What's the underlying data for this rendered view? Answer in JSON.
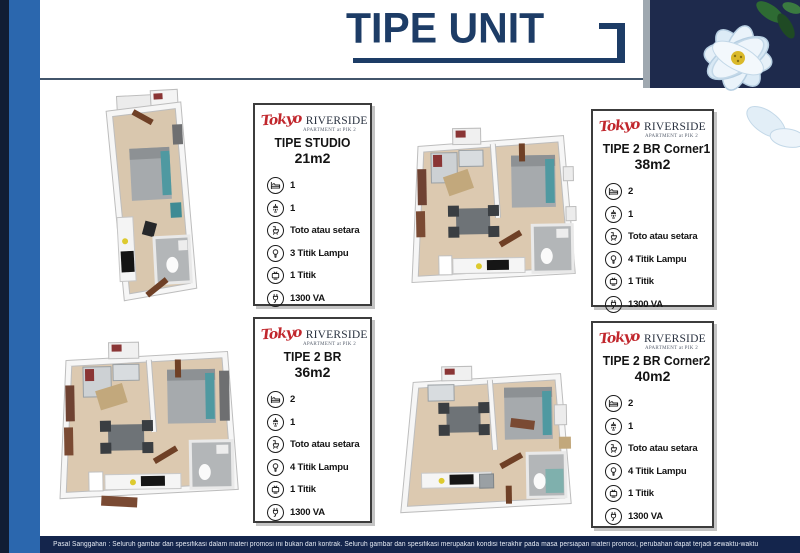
{
  "header": {
    "title": "TIPE UNIT"
  },
  "brand": {
    "script": "Tokyo",
    "serif": "RIVERSIDE",
    "sub": "APARTMENT at PIK 2"
  },
  "colors": {
    "title_navy": "#1d3c66",
    "panel_navy": "#1e2a4c",
    "side_blue": "#2b67ae",
    "footer_navy": "#14254c",
    "logo_red": "#c1272d"
  },
  "units": [
    {
      "name": "TIPE STUDIO",
      "size": "21m2",
      "specs": [
        {
          "icon": "bed-icon",
          "label": "1"
        },
        {
          "icon": "shower-icon",
          "label": "1"
        },
        {
          "icon": "toilet-icon",
          "label": "Toto atau setara"
        },
        {
          "icon": "lamp-icon",
          "label": "3 Titik Lampu"
        },
        {
          "icon": "tv-icon",
          "label": "1 Titik"
        },
        {
          "icon": "power-icon",
          "label": "1300 VA"
        }
      ]
    },
    {
      "name": "TIPE 2 BR Corner1",
      "size": "38m2",
      "specs": [
        {
          "icon": "bed-icon",
          "label": "2"
        },
        {
          "icon": "shower-icon",
          "label": "1"
        },
        {
          "icon": "toilet-icon",
          "label": "Toto atau setara"
        },
        {
          "icon": "lamp-icon",
          "label": "4 Titik Lampu"
        },
        {
          "icon": "tv-icon",
          "label": "1 Titik"
        },
        {
          "icon": "power-icon",
          "label": "1300 VA"
        }
      ]
    },
    {
      "name": "TIPE 2 BR",
      "size": "36m2",
      "specs": [
        {
          "icon": "bed-icon",
          "label": "2"
        },
        {
          "icon": "shower-icon",
          "label": "1"
        },
        {
          "icon": "toilet-icon",
          "label": "Toto atau setara"
        },
        {
          "icon": "lamp-icon",
          "label": "4 Titik Lampu"
        },
        {
          "icon": "tv-icon",
          "label": "1 Titik"
        },
        {
          "icon": "power-icon",
          "label": "1300 VA"
        }
      ]
    },
    {
      "name": "TIPE 2 BR Corner2",
      "size": "40m2",
      "specs": [
        {
          "icon": "bed-icon",
          "label": "2"
        },
        {
          "icon": "shower-icon",
          "label": "1"
        },
        {
          "icon": "toilet-icon",
          "label": "Toto atau setara"
        },
        {
          "icon": "lamp-icon",
          "label": "4 Titik Lampu"
        },
        {
          "icon": "tv-icon",
          "label": "1 Titik"
        },
        {
          "icon": "power-icon",
          "label": "1300 VA"
        }
      ]
    }
  ],
  "footer": {
    "disclaimer": "Pasal Sanggahan : Seluruh gambar dan spesifikasi dalam materi promosi ini bukan dari kontrak. Seluruh gambar dan spesifikasi merupakan kondisi terakhir pada masa persiapan materi promosi, perubahan dapat terjadi sewaktu-waktu"
  }
}
